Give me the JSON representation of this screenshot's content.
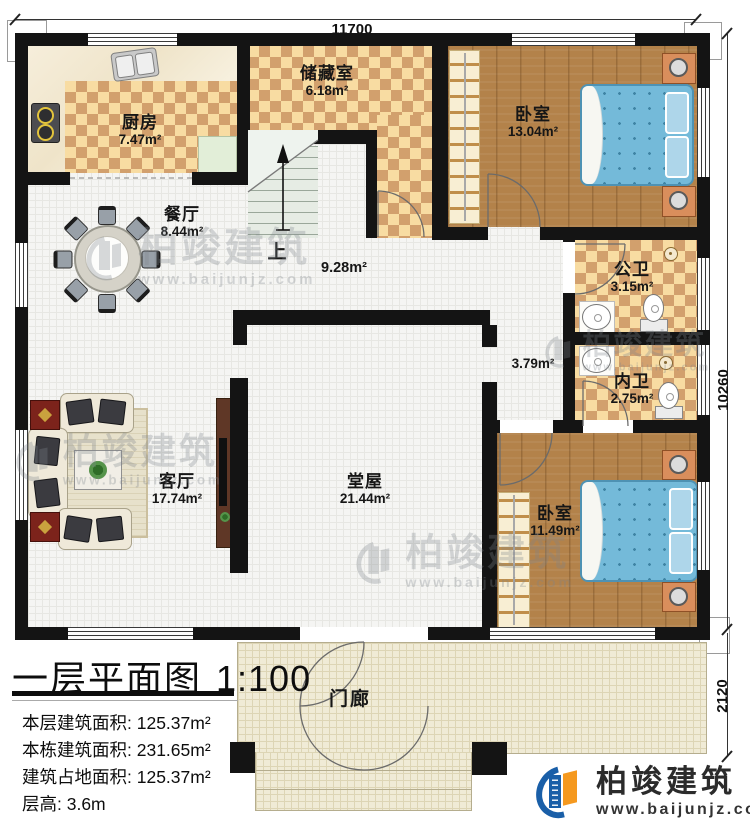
{
  "dimensions": {
    "top": "11700",
    "right": "10260",
    "bottom_right": "2120"
  },
  "rooms": {
    "kitchen": {
      "name": "厨房",
      "area": "7.47m²"
    },
    "storage": {
      "name": "储藏室",
      "area": "6.18m²"
    },
    "bedroom_top": {
      "name": "卧室",
      "area": "13.04m²"
    },
    "dining": {
      "name": "餐厅",
      "area": "8.44m²"
    },
    "stairs": {
      "up_label": "上"
    },
    "hallway": {
      "area": "9.28m²"
    },
    "corridor": {
      "area": "3.79m²"
    },
    "public_bath": {
      "name": "公卫",
      "area": "3.15m²"
    },
    "private_bath": {
      "name": "内卫",
      "area": "2.75m²"
    },
    "living": {
      "name": "客厅",
      "area": "17.74m²"
    },
    "hall": {
      "name": "堂屋",
      "area": "21.44m²"
    },
    "bedroom_bottom": {
      "name": "卧室",
      "area": "11.49m²"
    },
    "porch": {
      "name": "门廊"
    }
  },
  "title_block": {
    "title": "一层平面图",
    "scale": "1:100",
    "lines": [
      "本层建筑面积: 125.37m²",
      "本栋建筑面积: 231.65m²",
      "建筑占地面积: 125.37m²",
      "层高: 3.6m"
    ]
  },
  "branding": {
    "name": "柏竣建筑",
    "url": "www.baijunjz.com"
  },
  "watermark": {
    "name": "柏竣建筑",
    "url": "www.baijunjz.com"
  },
  "colors": {
    "wall": "#141414",
    "bed": "#74bad9",
    "logo_blue": "#1a5fa8",
    "logo_orange": "#f5991f"
  }
}
